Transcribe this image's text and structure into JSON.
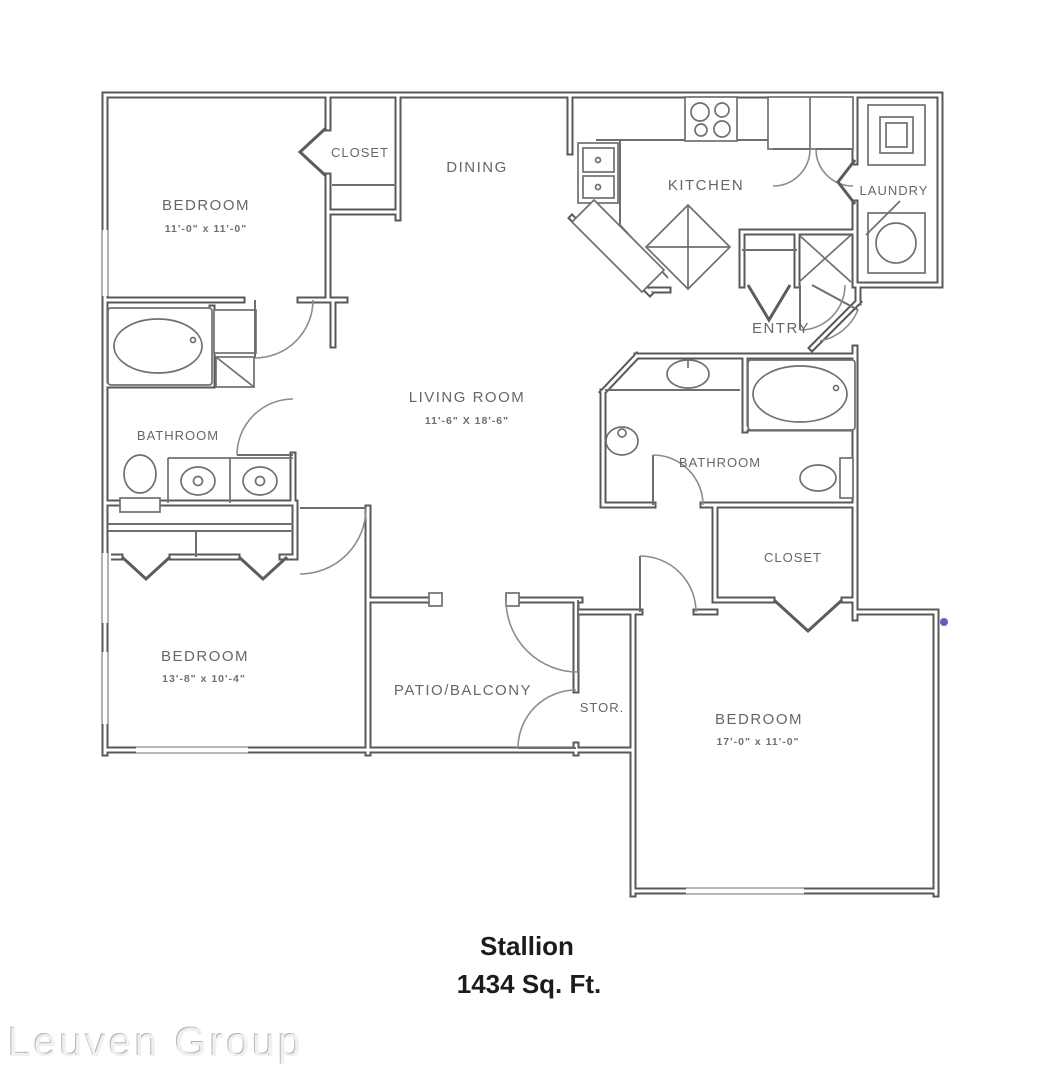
{
  "page": {
    "bg": "#ffffff"
  },
  "plan": {
    "title": "Stallion",
    "area_label": "1434 Sq. Ft.",
    "watermark": "Leuven Group",
    "rooms": {
      "bedroom1": {
        "label": "BEDROOM",
        "dims": "11'-0\" x 11'-0\""
      },
      "closet1": {
        "label": "CLOSET"
      },
      "dining": {
        "label": "DINING"
      },
      "kitchen": {
        "label": "KITCHEN"
      },
      "laundry": {
        "label": "LAUNDRY"
      },
      "entry": {
        "label": "ENTRY"
      },
      "living_room": {
        "label": "LIVING ROOM",
        "dims": "11'-6\" X 18'-6\""
      },
      "bathroom1": {
        "label": "BATHROOM"
      },
      "bathroom2": {
        "label": "BATHROOM"
      },
      "closet2": {
        "label": "CLOSET"
      },
      "bedroom2": {
        "label": "BEDROOM",
        "dims": "13'-8\" x 10'-4\""
      },
      "patio": {
        "label": "PATIO/BALCONY"
      },
      "storage": {
        "label": "STOR."
      },
      "bedroom3": {
        "label": "BEDROOM",
        "dims": "17'-0\" x 11'-0\""
      }
    },
    "colors": {
      "wall": "#585858",
      "fixture": "#707070",
      "door": "#8c8c8c",
      "label": "#676767",
      "title": "#1c1c1c",
      "watermark": "#f0f0f0",
      "accent_dot": "#4a3fb5"
    }
  }
}
